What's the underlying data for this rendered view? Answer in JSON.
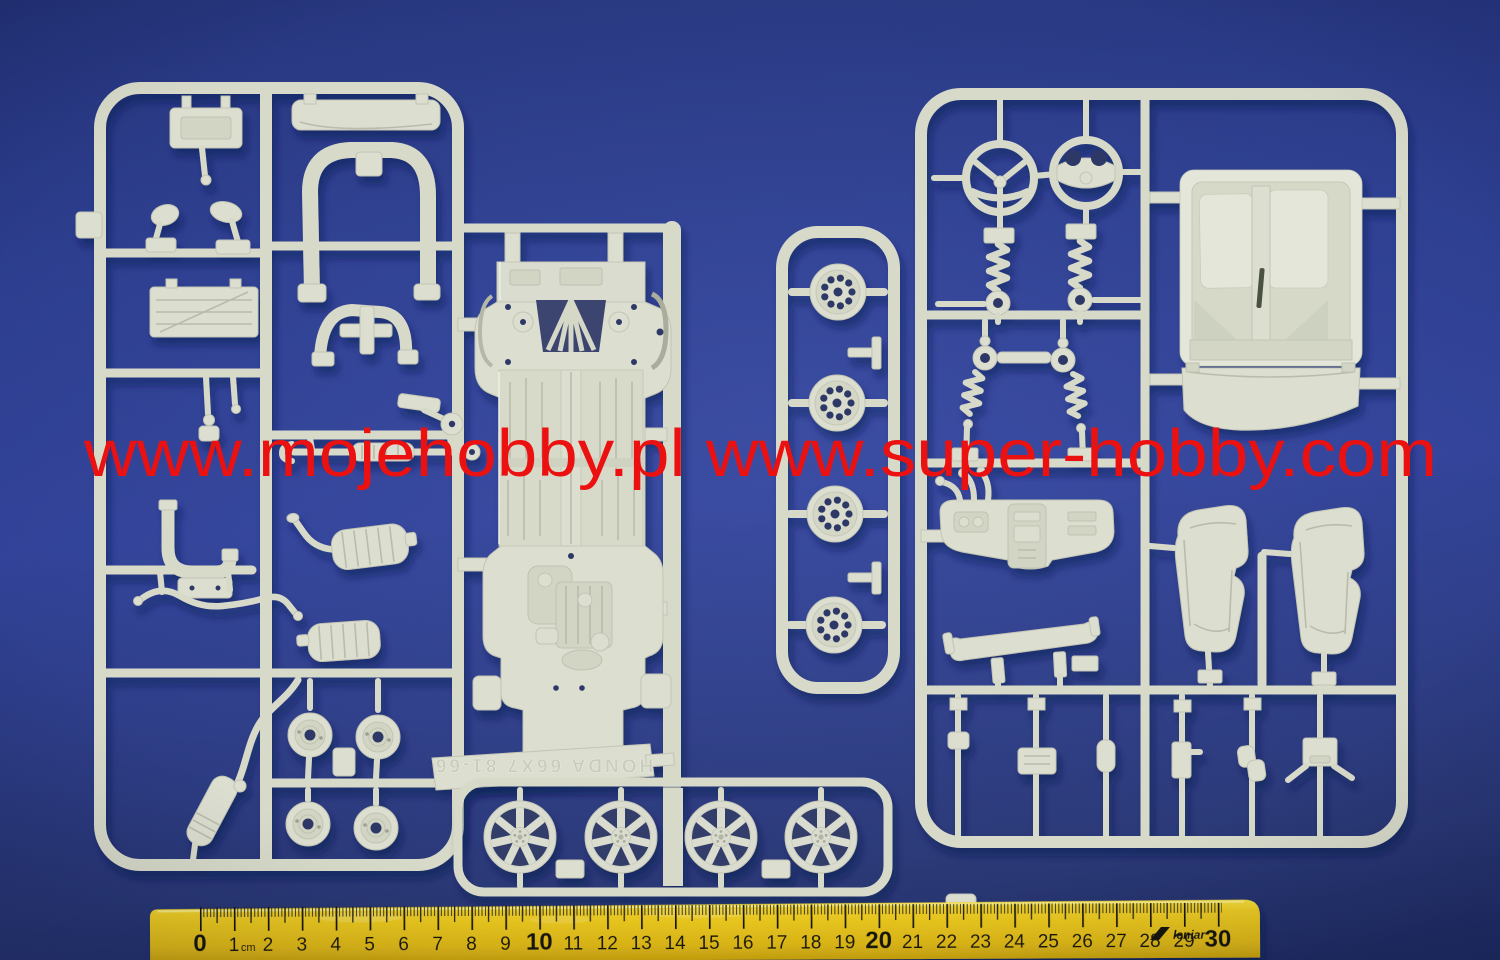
{
  "watermark": {
    "text": "www.mojehobby.pl www.super-hobby.com",
    "color": "#ec1111"
  },
  "ruler": {
    "numbers": [
      "0",
      "1",
      "2",
      "3",
      "4",
      "5",
      "6",
      "7",
      "8",
      "9",
      "10",
      "11",
      "12",
      "13",
      "14",
      "15",
      "16",
      "17",
      "18",
      "19",
      "20",
      "21",
      "22",
      "23",
      "24",
      "25",
      "26",
      "27",
      "28",
      "29",
      "30"
    ],
    "unit": "cm",
    "brand": "leniar",
    "body_color": "#eccb22",
    "tick_color": "#15150f"
  },
  "sprue_tag": {
    "embossed_text": "HONDA 66X7 81-66"
  },
  "colors": {
    "background": "#2a3a8c",
    "plastic": "#dcded0",
    "plastic_shadow": "#b9bcab",
    "plastic_highlight": "#edefe2",
    "wheel_hole": "#2e3866"
  }
}
